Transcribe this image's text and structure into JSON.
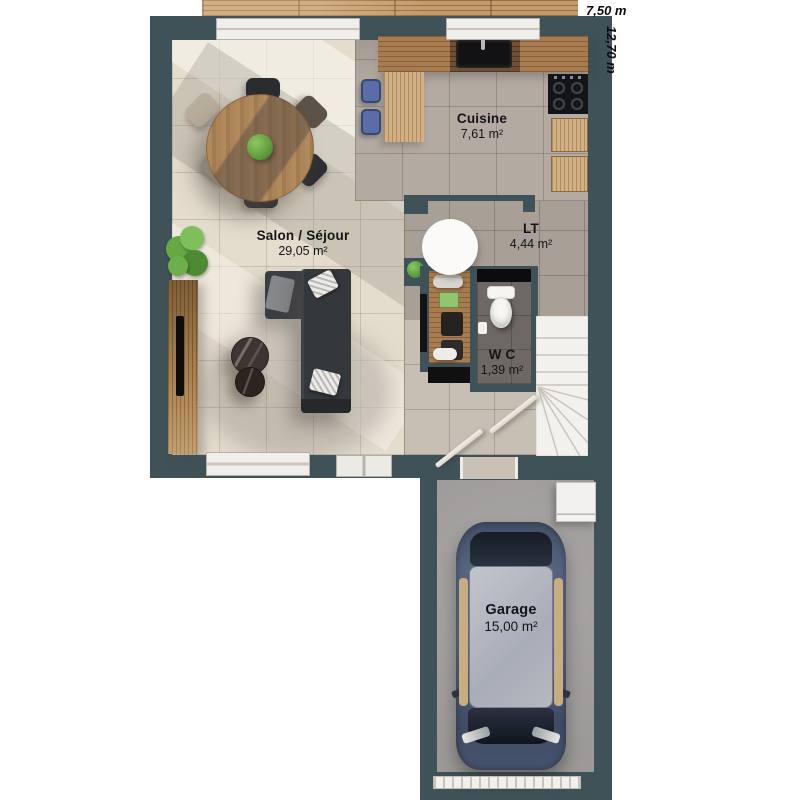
{
  "dimensions": {
    "width_label": "7,50 m",
    "depth_label": "12,70 m"
  },
  "rooms": {
    "cuisine": {
      "name": "Cuisine",
      "area": "7,61 m²"
    },
    "salon": {
      "name": "Salon / Séjour",
      "area": "29,05 m²"
    },
    "entry": {
      "name": "LT",
      "area": "4,44 m²"
    },
    "wc": {
      "name": "W C",
      "area": "1,39 m²"
    },
    "garage": {
      "name": "Garage",
      "area": "15,00 m²"
    }
  },
  "colors": {
    "wall": "#3e5257",
    "living_floor": "#e4ddce",
    "kitchen_floor": "#b3aaa2",
    "entry_floor": "#a89f97",
    "hall_floor": "#c7bfb3",
    "wc_floor": "#6d6864",
    "garage_floor": "#a5a2a0",
    "deck_wood": "#c49a6a",
    "counter_wood": "#a87c4f",
    "sofa": "#34373c",
    "car_body": "#4e5d78",
    "stool_blue": "#5a6da8",
    "plant_green": "#6fae4c"
  }
}
